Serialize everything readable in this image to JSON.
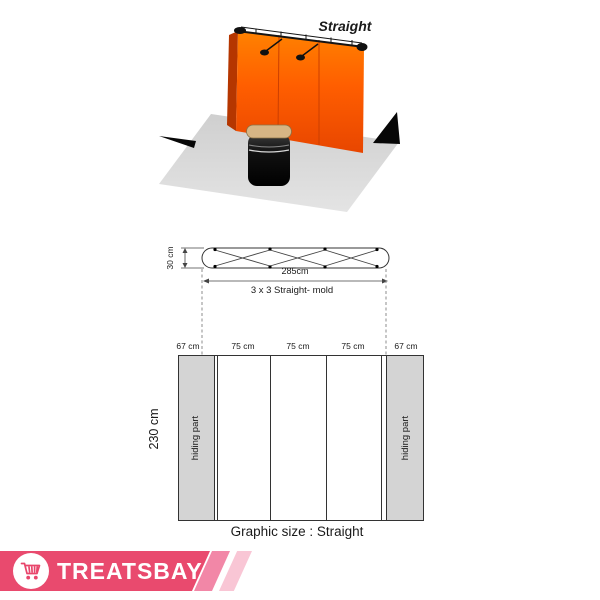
{
  "scene": {
    "title": "Straight"
  },
  "frame_diagram": {
    "depth_label": "30 cm",
    "width_label": "285cm",
    "mold_label": "3 x 3 Straight- mold"
  },
  "graphic_diagram": {
    "height_label": "230 cm",
    "panel_widths": [
      "67 cm",
      "75 cm",
      "75 cm",
      "75 cm",
      "67 cm"
    ],
    "hiding_left": "hiding part",
    "hiding_right": "hiding part",
    "caption": "Graphic size : Straight"
  },
  "footer": {
    "brand": "TREATSBAY",
    "cart_icon": "shopping-cart-icon"
  },
  "colors": {
    "wall_orange_top": "#ff8200",
    "wall_orange_mid": "#ff5e00",
    "wall_orange_bottom": "#e84600",
    "wall_side_dark": "#b53600",
    "floor_gray": "#d9d9d9",
    "hiding_gray": "#d4d4d4",
    "podium_top_tan": "#d6b585",
    "banner_pink": "#e94a6e",
    "stripe_medium": "#f287a7",
    "stripe_light": "#f9c6d5"
  }
}
